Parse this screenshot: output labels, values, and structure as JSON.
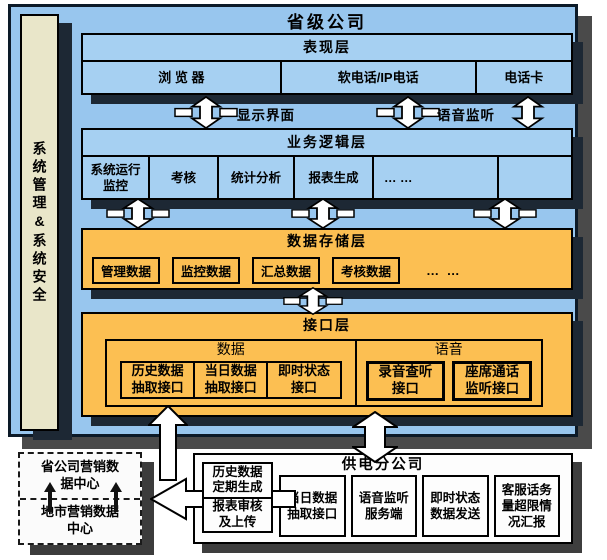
{
  "header": {
    "title": "省级公司"
  },
  "sidebar": {
    "label": "系统管理&系统安全"
  },
  "presentation": {
    "title": "表现层",
    "cells": [
      "浏 览 器",
      "软电话/IP电话",
      "电话卡"
    ]
  },
  "flow_labels": {
    "display": "显示界面",
    "voice": "语音监听"
  },
  "business": {
    "title": "业务逻辑层",
    "cells": [
      "系统运行监控",
      "考核",
      "统计分析",
      "报表生成",
      "… …"
    ]
  },
  "storage": {
    "title": "数据存储层",
    "boxes": [
      "管理数据",
      "监控数据",
      "汇总数据",
      "考核数据"
    ],
    "ellipsis": "… …"
  },
  "interface": {
    "title": "接口层",
    "data_group": {
      "label": "数据",
      "cells": [
        "历史数据抽取接口",
        "当日数据抽取接口",
        "即时状态接口"
      ]
    },
    "voice_group": {
      "label": "语音",
      "boxes": [
        "录音查听接口",
        "座席通话监听接口"
      ]
    }
  },
  "marketing": {
    "top": "省公司营销数据中心",
    "bottom": "地市营销数据中心"
  },
  "report": {
    "cells": [
      "历史数据定期生成",
      "报表审核及上传"
    ]
  },
  "branch": {
    "title": "供电分公司",
    "boxes": [
      "当日数据抽取接口",
      "语音监听服务端",
      "即时状态数据发送",
      "客服话务量超限情况汇报"
    ]
  },
  "colors": {
    "container_blue": "#98c6ee",
    "panel_blue": "#a6d0f2",
    "panel_orange": "#fcbf52",
    "sidebar_beige": "#e9e6c9",
    "panel_shadow": "#1d2834",
    "outer_shadow": "#4a4a4a",
    "arrow_fill": "#ffffff",
    "arrow_stroke": "#000000"
  }
}
